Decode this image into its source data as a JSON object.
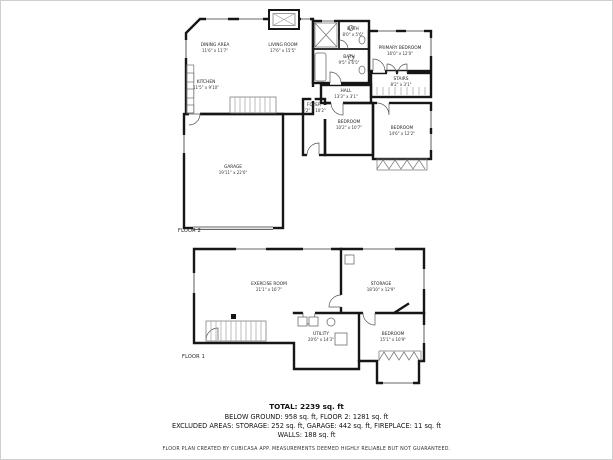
{
  "floor2": {
    "label": "FLOOR 2",
    "rooms": {
      "dining": {
        "name": "DINING AREA",
        "dims": "11'6\" x 11'7\""
      },
      "living": {
        "name": "LIVING ROOM",
        "dims": "17'6\" x 15'5\""
      },
      "kitchen": {
        "name": "KITCHEN",
        "dims": "11'5\" x 9'10\""
      },
      "bath1": {
        "name": "BATH",
        "dims": "8'0\" x 5'6\""
      },
      "bath2": {
        "name": "BATH",
        "dims": "9'5\" x 6'5\""
      },
      "primary": {
        "name": "PRIMARY BEDROOM",
        "dims": "16'0\" x 12'0\""
      },
      "hall": {
        "name": "HALL",
        "dims": "13'3\" x 3'1\""
      },
      "stairs": {
        "name": "STAIRS",
        "dims": "8'2\" x 3'1\""
      },
      "foyer": {
        "name": "FOYER",
        "dims": "6'2\" x 10'2\""
      },
      "bedroom2": {
        "name": "BEDROOM",
        "dims": "10'2\" x 10'7\""
      },
      "bedroom3": {
        "name": "BEDROOM",
        "dims": "14'6\" x 12'2\""
      },
      "garage": {
        "name": "GARAGE",
        "dims": "19'11\" x 22'0\""
      }
    }
  },
  "floor1": {
    "label": "FLOOR 1",
    "rooms": {
      "exercise": {
        "name": "EXERCISE ROOM",
        "dims": "21'1\" x 16'7\""
      },
      "storage": {
        "name": "STORAGE",
        "dims": "18'10\" x 12'9\""
      },
      "utility": {
        "name": "UTILITY",
        "dims": "20'6\" x 14'3\""
      },
      "bedroom": {
        "name": "BEDROOM",
        "dims": "15'1\" x 10'9\""
      }
    }
  },
  "summary": {
    "total": "TOTAL: 2239 sq. ft",
    "line2": "BELOW GROUND: 958 sq. ft, FLOOR 2: 1281 sq. ft",
    "line3": "EXCLUDED AREAS: STORAGE: 252 sq. ft, GARAGE: 442 sq. ft, FIREPLACE: 11 sq. ft",
    "line4": "WALLS: 188 sq. ft"
  },
  "footer": "FLOOR PLAN CREATED BY CUBICASA APP. MEASUREMENTS DEEMED HIGHLY RELIABLE BUT NOT GUARANTEED.",
  "colors": {
    "wall": "#161616",
    "label": "#222222",
    "background": "#ffffff"
  }
}
